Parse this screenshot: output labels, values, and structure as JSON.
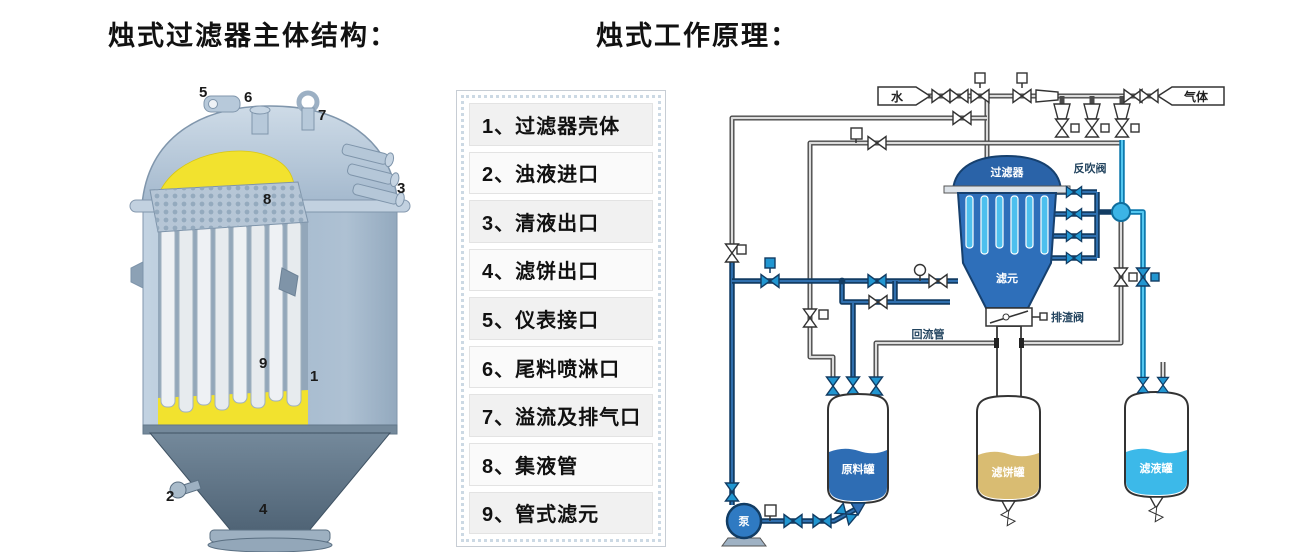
{
  "sections": {
    "structure": {
      "title": "烛式过滤器主体结构："
    },
    "principle": {
      "title": "烛式工作原理："
    }
  },
  "parts_list": {
    "items": [
      "1、过滤器壳体",
      "2、浊液进口",
      "3、清液出口",
      "4、滤饼出口",
      "5、仪表接口",
      "6、尾料喷淋口",
      "7、溢流及排气口",
      "8、集液管",
      "9、管式滤元"
    ]
  },
  "structure_diagram": {
    "callouts": [
      "1",
      "2",
      "3",
      "4",
      "5",
      "6",
      "7",
      "8",
      "9"
    ]
  },
  "principle_diagram": {
    "labels": {
      "water": "水",
      "gas": "气体",
      "filter": "过滤器",
      "filter_elements": "滤元",
      "backblow_valve": "反吹阀",
      "slag_discharge_valve": "排渣阀",
      "return_pipe": "回流管",
      "feed_tank": "原料罐",
      "cake_tank": "滤饼罐",
      "filtrate_tank": "滤液罐",
      "pump": "泵"
    },
    "colors": {
      "vessel_blue": "#2e6fba",
      "candle_cyan": "#4ec0ee",
      "feed_liquid": "#2e6db4",
      "cake_liquid": "#d9bc72",
      "filtrate_liquid": "#3cb9e9",
      "slurry_yellow": "#f2e22e",
      "valve_blue": "#2196d1"
    }
  }
}
